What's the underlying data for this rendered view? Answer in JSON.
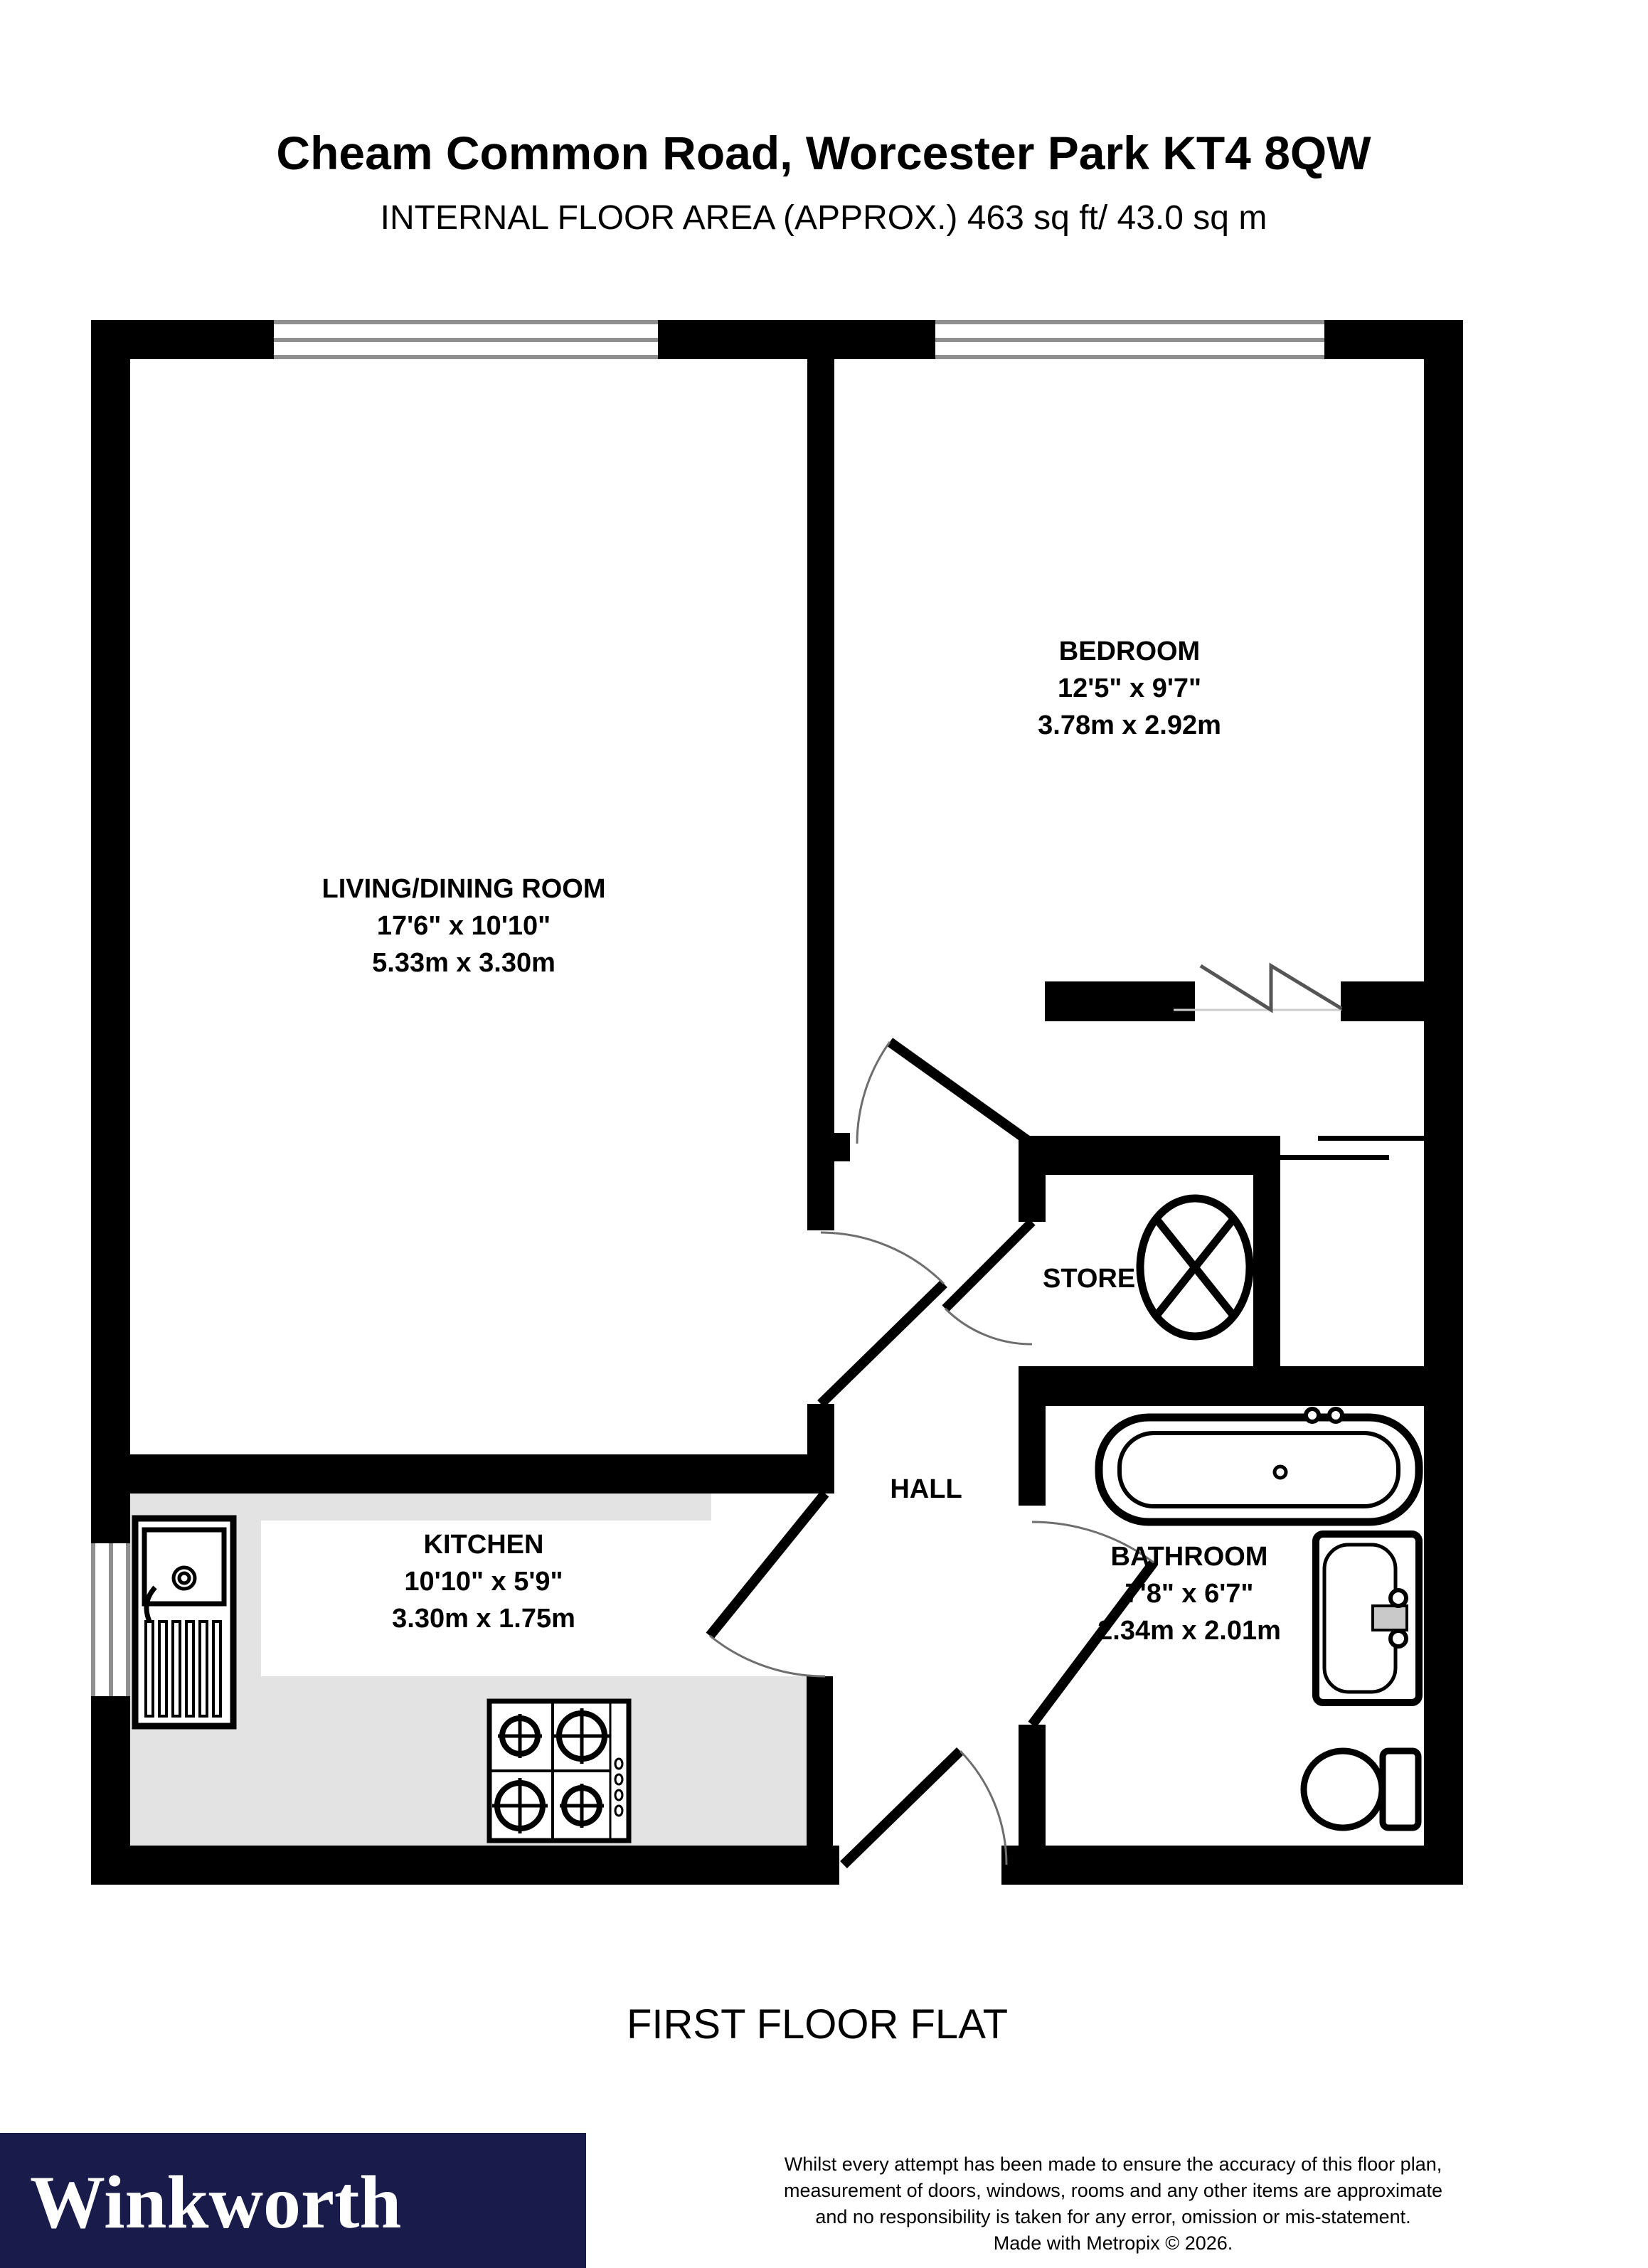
{
  "header": {
    "title": "Cheam Common Road, Worcester Park KT4 8QW",
    "subtitle": "INTERNAL FLOOR AREA (APPROX.) 463 sq ft/ 43.0 sq m"
  },
  "rooms": {
    "living": {
      "name": "LIVING/DINING ROOM",
      "imperial": "17'6\" x 10'10\"",
      "metric": "5.33m x 3.30m"
    },
    "bedroom": {
      "name": "BEDROOM",
      "imperial": "12'5\" x 9'7\"",
      "metric": "3.78m x 2.92m"
    },
    "kitchen": {
      "name": "KITCHEN",
      "imperial": "10'10\" x 5'9\"",
      "metric": "3.30m x 1.75m"
    },
    "bathroom": {
      "name": "BATHROOM",
      "imperial": "7'8\" x 6'7\"",
      "metric": "2.34m x 2.01m"
    },
    "store": {
      "name": "STORE"
    },
    "hall": {
      "name": "HALL"
    }
  },
  "floor_label": "FIRST FLOOR FLAT",
  "footer": {
    "brand": "Winkworth",
    "disclaimer_lines": [
      "Whilst every attempt has been made to ensure the accuracy of this floor plan,",
      "measurement of doors, windows, rooms and any other items are approximate",
      "and no responsibility is taken for any error, omission or mis-statement.",
      "Made with Metropix © 2026."
    ]
  },
  "colors": {
    "wall": "#000000",
    "counter": "#e3e3e3",
    "window_line": "#8f8f8f",
    "door_arc": "#6e6e6e",
    "brand_bg": "#191c4a",
    "brand_text": "#ffffff"
  },
  "symbols": [
    "window-symbol",
    "door-arc-symbol",
    "water-cylinder-icon",
    "bath-icon",
    "basin-icon",
    "toilet-icon",
    "kitchen-sink-icon",
    "hob-icon",
    "opening-zigzag-symbol"
  ]
}
